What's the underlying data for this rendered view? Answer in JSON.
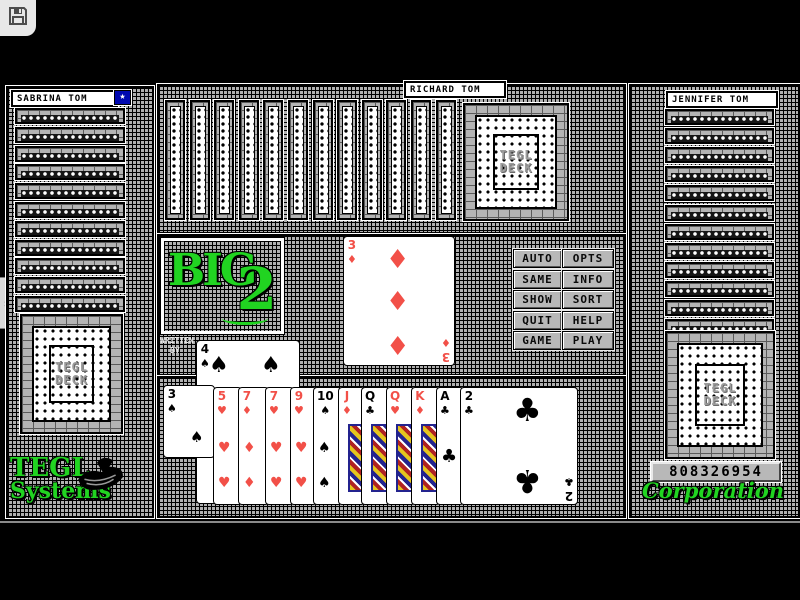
{
  "titlebar": {
    "save_icon": "floppy-disk"
  },
  "players": {
    "left": {
      "name": "SABRINA TOM",
      "facedown_cards": 11,
      "deck_card_back": true,
      "turn_star": "★"
    },
    "top": {
      "name": "RICHARD TOM",
      "facedown_cards": 12,
      "deck_card_back": true
    },
    "right": {
      "name": "JENNIFER TOM",
      "facedown_cards": 12,
      "deck_card_back": true
    },
    "bottom": {
      "credit_line1": "WRITTEN",
      "credit_line2": "BY"
    }
  },
  "logo": {
    "word": "BIG",
    "numeral": "2"
  },
  "deck_back_label": {
    "line1": "TEGL",
    "line2": "DECK"
  },
  "menu_buttons": [
    "AUTO",
    "OPTS",
    "SAME",
    "INFO",
    "SHOW",
    "SORT",
    "QUIT",
    "HELP",
    "GAME",
    "PLAY"
  ],
  "center_played_card": {
    "rank": "3",
    "suit": "diamond"
  },
  "table_card": {
    "rank": "4",
    "suit": "spade"
  },
  "hand_cards": [
    {
      "rank": "3",
      "suit": "spade",
      "raised": true
    },
    {
      "rank": "5",
      "suit": "heart"
    },
    {
      "rank": "7",
      "suit": "diamond"
    },
    {
      "rank": "7",
      "suit": "heart"
    },
    {
      "rank": "9",
      "suit": "heart"
    },
    {
      "rank": "10",
      "suit": "spade"
    },
    {
      "rank": "J",
      "suit": "diamond",
      "face": true
    },
    {
      "rank": "Q",
      "suit": "club",
      "face": true
    },
    {
      "rank": "Q",
      "suit": "heart",
      "face": true
    },
    {
      "rank": "K",
      "suit": "diamond",
      "face": true
    },
    {
      "rank": "A",
      "suit": "club"
    },
    {
      "rank": "2",
      "suit": "club",
      "last": true
    }
  ],
  "score_display": "808326954",
  "branding": {
    "left_line1": "TEGL",
    "left_line2": "Systems",
    "right": "Corporation",
    "logo": "swan"
  },
  "side_tab": {
    "glyph": "›"
  },
  "colors": {
    "suit_red": "#f25048",
    "suit_black": "#000000",
    "brand_green": "#21d421",
    "star_blue": "#0008b0",
    "checker_gray": "#b0b0b0"
  }
}
